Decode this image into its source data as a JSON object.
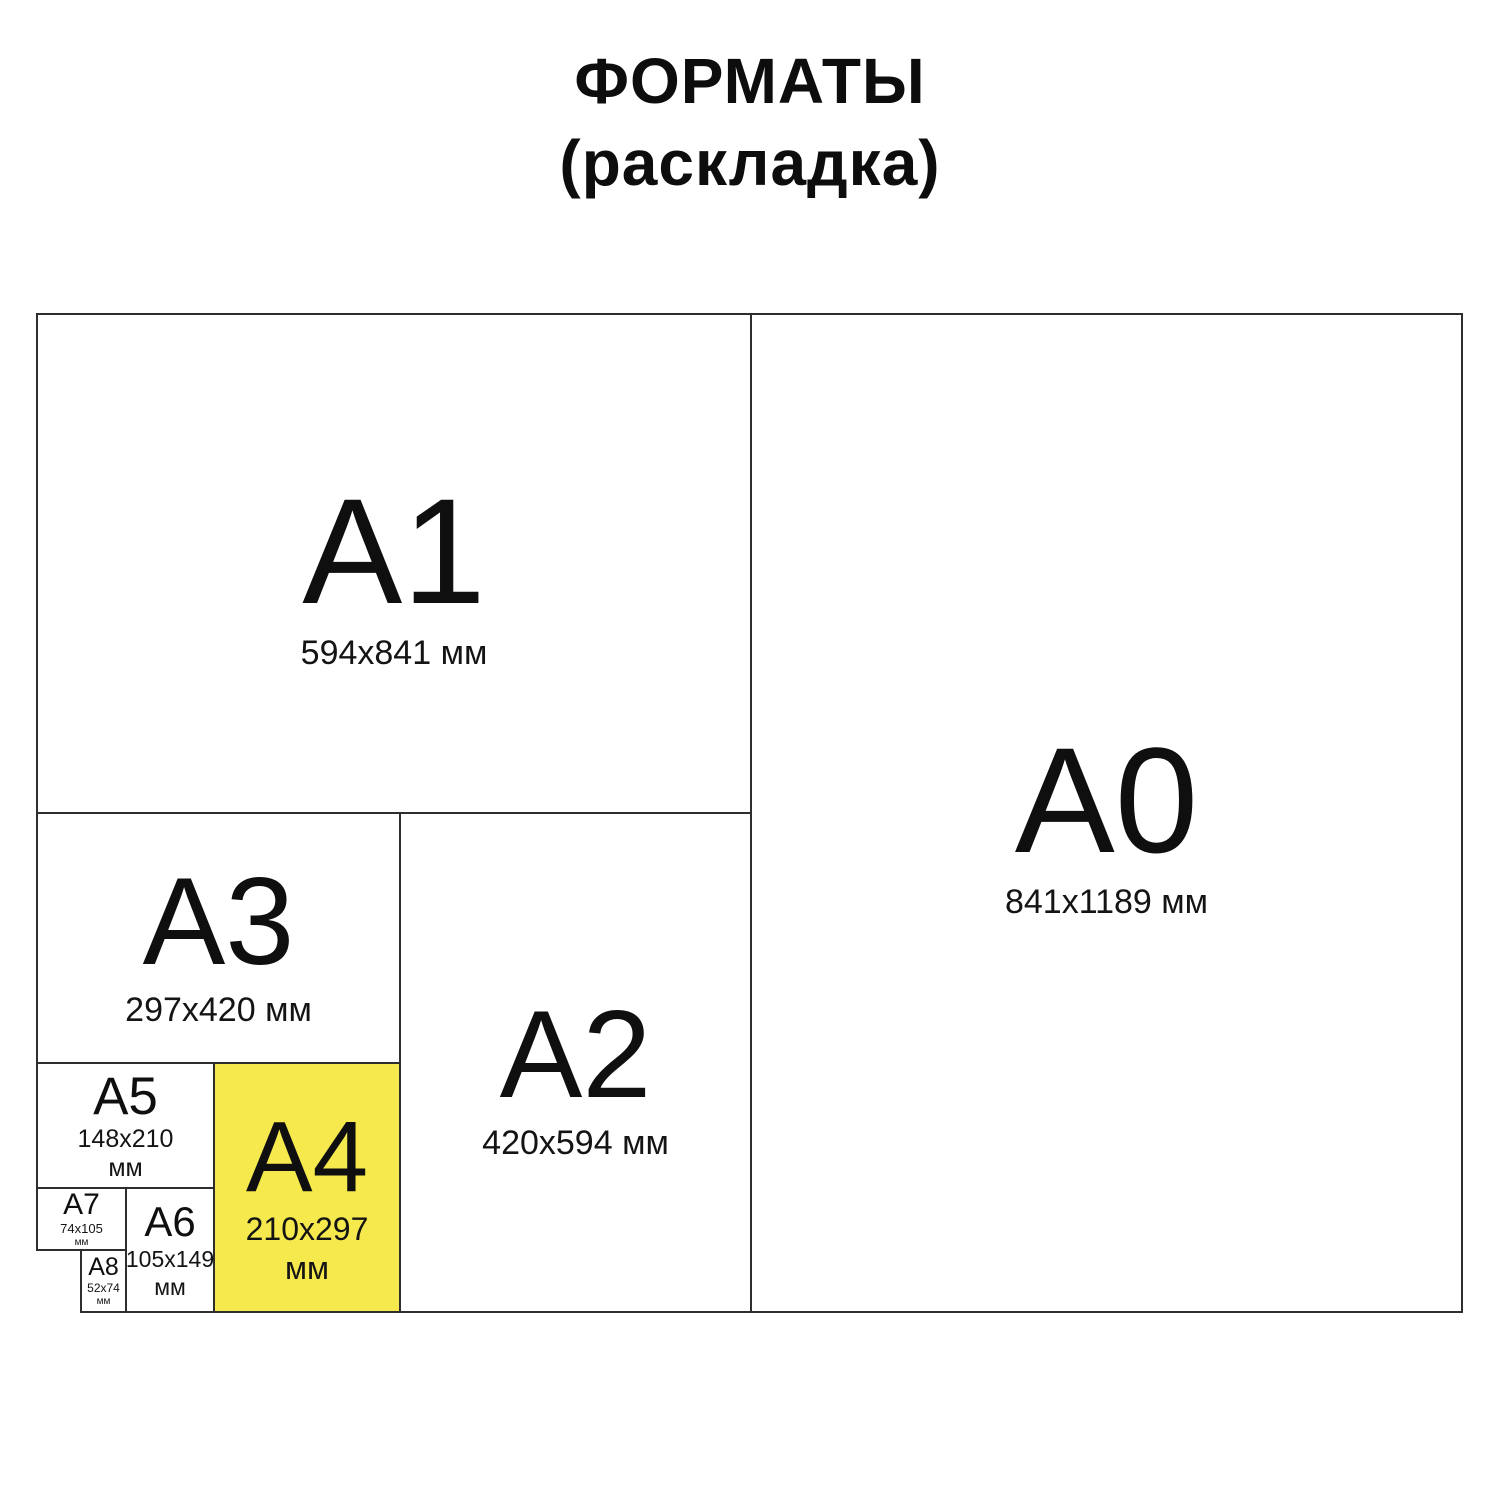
{
  "title": {
    "line1": "ФОРМАТЫ",
    "line2": "(раскладка)"
  },
  "colors": {
    "highlight_a4": "#f5e94e",
    "line": "#2e2e2e",
    "text": "#111111",
    "background": "#ffffff"
  },
  "formats": {
    "a0": {
      "label": "A0",
      "size": "841x1189 мм"
    },
    "a1": {
      "label": "A1",
      "size": "594x841 мм"
    },
    "a2": {
      "label": "A2",
      "size": "420x594 мм"
    },
    "a3": {
      "label": "A3",
      "size": "297x420 мм"
    },
    "a4": {
      "label": "A4",
      "size": "210x297",
      "unit": "мм",
      "highlighted": true
    },
    "a5": {
      "label": "A5",
      "size": "148x210",
      "unit": "мм"
    },
    "a6": {
      "label": "A6",
      "size": "105x149",
      "unit": "мм"
    },
    "a7": {
      "label": "A7",
      "size": "74x105",
      "unit": "мм"
    },
    "a8": {
      "label": "A8",
      "size": "52x74",
      "unit": "мм"
    }
  }
}
